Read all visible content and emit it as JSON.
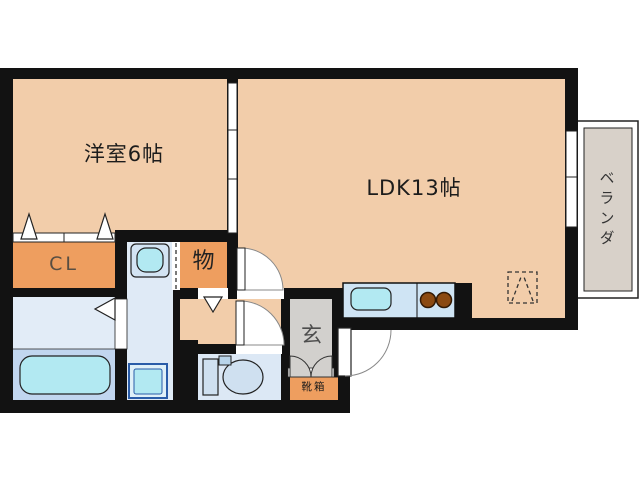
{
  "floorplan": {
    "rooms": {
      "western_room": {
        "label": "洋室6帖"
      },
      "ldk": {
        "label": "LDK13帖"
      },
      "balcony": {
        "label": "ベランダ"
      },
      "closet": {
        "label": "CL"
      },
      "storage": {
        "label": "物"
      },
      "entrance": {
        "label": "玄"
      },
      "shoe_box": {
        "label": "靴箱"
      }
    },
    "colors": {
      "c-peach": "#f2cdaa",
      "c-orange": "#ee9e5f",
      "c-wall": "#121212",
      "c-wet": "#dfeaf6",
      "c-bath": "#c1d6ef",
      "c-cyan": "#b2e9f2",
      "c-counter": "#cfe4f4",
      "c-gray": "#d2d0cd",
      "c-balcony": "#d8d1c9",
      "c-burner": "#8b4a12"
    }
  }
}
